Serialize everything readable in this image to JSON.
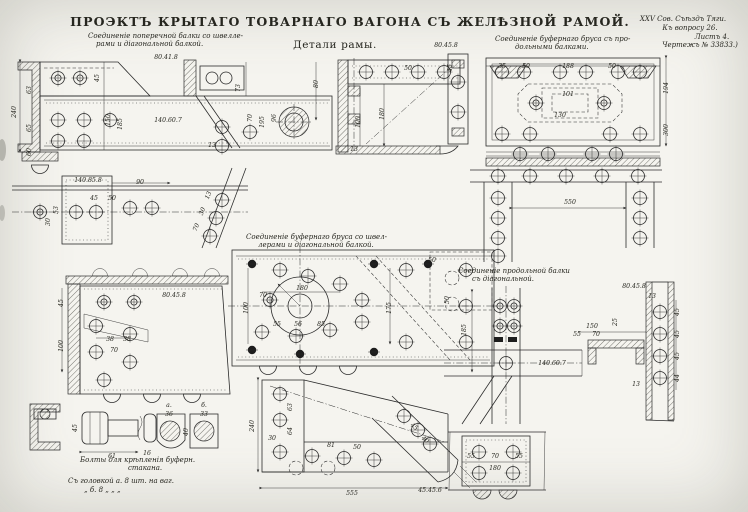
{
  "page": {
    "title": "ПРОЭКТЪ КРЫТАГО ТОВАРНАГО ВАГОНА СЪ ЖЕЛѢЗНОЙ РАМОЙ.",
    "subtitle": "Детали рамы.",
    "corner_note": [
      "XXV Сов. Съѣздъ Тяги.",
      "Къ вопросу 26.",
      "Листъ 4.",
      "Чертежъ № 33833.)"
    ]
  },
  "captions": {
    "transverse_line1": "Соединеніе поперечной балки со швелле-",
    "transverse_line2": "рами и діагональной балкой.",
    "buffer_longitudinal_line1": "Соединеніе буфернаго бруса съ про-",
    "buffer_longitudinal_line2": "дольными балками.",
    "buffer_channel_line1": "Соединеніе буфернаго бруса со швел-",
    "buffer_channel_line2": "лерами и діагональной балкой.",
    "longitudinal_diagonal_line1": "Соединеніе продольной балки",
    "longitudinal_diagonal_line2": "съ діагональной.",
    "bolts_line1": "Болты для крѣпленія буферн.",
    "bolts_line2": "стакана.",
    "bolts_spec1": "Съ головкой а.   8 шт. на ваг.",
    "bolts_spec2": "„     б.   8   „    „    „"
  },
  "colors": {
    "paper": "#f5f4ef",
    "ink": "#2b2b2b"
  },
  "dim_labels": [
    {
      "t": "80.41.8",
      "x": 166,
      "y": 59
    },
    {
      "t": "140.60.7",
      "x": 168,
      "y": 122
    },
    {
      "t": "240",
      "x": 16,
      "y": 112,
      "r": -90
    },
    {
      "t": "63",
      "x": 31,
      "y": 90,
      "r": -90
    },
    {
      "t": "65",
      "x": 31,
      "y": 128,
      "r": -90
    },
    {
      "t": "60",
      "x": 31,
      "y": 152,
      "r": -90
    },
    {
      "t": "45",
      "x": 99,
      "y": 78,
      "r": -90
    },
    {
      "t": "150",
      "x": 110,
      "y": 120,
      "r": -90
    },
    {
      "t": "185",
      "x": 122,
      "y": 124,
      "r": -90
    },
    {
      "t": "73",
      "x": 240,
      "y": 88,
      "r": -90
    },
    {
      "t": "70",
      "x": 252,
      "y": 118,
      "r": -90
    },
    {
      "t": "195",
      "x": 264,
      "y": 122,
      "r": -90
    },
    {
      "t": "96",
      "x": 276,
      "y": 118,
      "r": -90
    },
    {
      "t": "80",
      "x": 318,
      "y": 84,
      "r": -90
    },
    {
      "t": "13",
      "x": 212,
      "y": 147
    },
    {
      "t": "180",
      "x": 384,
      "y": 114,
      "r": -90
    },
    {
      "t": "100",
      "x": 360,
      "y": 122,
      "r": -90
    },
    {
      "t": "50",
      "x": 408,
      "y": 70
    },
    {
      "t": "45",
      "x": 452,
      "y": 68,
      "r": -90
    },
    {
      "t": "13",
      "x": 354,
      "y": 151
    },
    {
      "t": "80.45.8",
      "x": 446,
      "y": 47
    },
    {
      "t": "35",
      "x": 502,
      "y": 68
    },
    {
      "t": "50",
      "x": 526,
      "y": 68
    },
    {
      "t": "188",
      "x": 568,
      "y": 68
    },
    {
      "t": "50",
      "x": 612,
      "y": 68
    },
    {
      "t": "101",
      "x": 568,
      "y": 96
    },
    {
      "t": "130",
      "x": 560,
      "y": 117
    },
    {
      "t": "194",
      "x": 668,
      "y": 88,
      "r": -90
    },
    {
      "t": "300",
      "x": 668,
      "y": 130,
      "r": -90
    },
    {
      "t": "140.85.8",
      "x": 88,
      "y": 182
    },
    {
      "t": "90",
      "x": 140,
      "y": 184
    },
    {
      "t": "45",
      "x": 94,
      "y": 200
    },
    {
      "t": "50",
      "x": 112,
      "y": 200
    },
    {
      "t": "53",
      "x": 58,
      "y": 210,
      "r": -90
    },
    {
      "t": "30",
      "x": 50,
      "y": 222,
      "r": -90
    },
    {
      "t": "13",
      "x": 210,
      "y": 196,
      "r": -68
    },
    {
      "t": "30",
      "x": 204,
      "y": 212,
      "r": -68
    },
    {
      "t": "70",
      "x": 198,
      "y": 228,
      "r": -68
    },
    {
      "t": "550",
      "x": 570,
      "y": 204
    },
    {
      "t": "180",
      "x": 302,
      "y": 290
    },
    {
      "t": "70",
      "x": 263,
      "y": 297
    },
    {
      "t": "55",
      "x": 277,
      "y": 326
    },
    {
      "t": "56",
      "x": 298,
      "y": 326
    },
    {
      "t": "85",
      "x": 321,
      "y": 326
    },
    {
      "t": "100",
      "x": 248,
      "y": 308,
      "r": -90
    },
    {
      "t": "175",
      "x": 391,
      "y": 308,
      "r": -90
    },
    {
      "t": "50",
      "x": 432,
      "y": 262
    },
    {
      "t": "50",
      "x": 449,
      "y": 300,
      "r": -90
    },
    {
      "t": "80.45.8",
      "x": 174,
      "y": 297
    },
    {
      "t": "45",
      "x": 63,
      "y": 303,
      "r": -90
    },
    {
      "t": "100",
      "x": 63,
      "y": 346,
      "r": -90
    },
    {
      "t": "38",
      "x": 110,
      "y": 341
    },
    {
      "t": "38",
      "x": 127,
      "y": 341
    },
    {
      "t": "70",
      "x": 114,
      "y": 352
    },
    {
      "t": "140.60.7",
      "x": 552,
      "y": 365
    },
    {
      "t": "185",
      "x": 466,
      "y": 330,
      "r": -90
    },
    {
      "t": "80.45.8",
      "x": 634,
      "y": 288
    },
    {
      "t": "13",
      "x": 652,
      "y": 298
    },
    {
      "t": "150",
      "x": 592,
      "y": 328
    },
    {
      "t": "55",
      "x": 577,
      "y": 336
    },
    {
      "t": "70",
      "x": 596,
      "y": 336
    },
    {
      "t": "25",
      "x": 617,
      "y": 322,
      "r": -90
    },
    {
      "t": "45",
      "x": 679,
      "y": 312,
      "r": -90
    },
    {
      "t": "45",
      "x": 679,
      "y": 334,
      "r": -90
    },
    {
      "t": "45",
      "x": 679,
      "y": 356,
      "r": -90
    },
    {
      "t": "44",
      "x": 679,
      "y": 378,
      "r": -90
    },
    {
      "t": "13",
      "x": 636,
      "y": 386
    },
    {
      "t": "240",
      "x": 254,
      "y": 426,
      "r": -90
    },
    {
      "t": "63",
      "x": 292,
      "y": 407,
      "r": -90
    },
    {
      "t": "64",
      "x": 292,
      "y": 431,
      "r": -90
    },
    {
      "t": "30",
      "x": 272,
      "y": 440
    },
    {
      "t": "81",
      "x": 331,
      "y": 447
    },
    {
      "t": "50",
      "x": 357,
      "y": 449
    },
    {
      "t": "45",
      "x": 413,
      "y": 428,
      "r": 40
    },
    {
      "t": "40",
      "x": 424,
      "y": 441,
      "r": 40
    },
    {
      "t": "555",
      "x": 352,
      "y": 495
    },
    {
      "t": "45.45.6",
      "x": 430,
      "y": 492
    },
    {
      "t": "55",
      "x": 471,
      "y": 458
    },
    {
      "t": "70",
      "x": 495,
      "y": 458
    },
    {
      "t": "55",
      "x": 519,
      "y": 458
    },
    {
      "t": "180",
      "x": 495,
      "y": 470
    },
    {
      "t": "а.",
      "x": 169,
      "y": 407,
      "s": 7.5
    },
    {
      "t": "б.",
      "x": 204,
      "y": 407,
      "s": 7.5
    },
    {
      "t": "36",
      "x": 169,
      "y": 416
    },
    {
      "t": "33",
      "x": 204,
      "y": 416
    },
    {
      "t": "61",
      "x": 112,
      "y": 458
    },
    {
      "t": "16",
      "x": 147,
      "y": 455
    },
    {
      "t": "45",
      "x": 77,
      "y": 428,
      "r": -90
    },
    {
      "t": "40",
      "x": 188,
      "y": 432,
      "r": -90
    }
  ]
}
